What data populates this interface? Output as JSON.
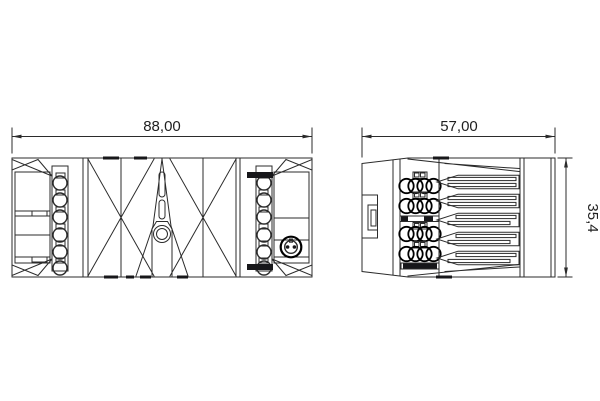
{
  "drawing": {
    "type": "technical-drawing",
    "dimensions": {
      "front_width": "88,00",
      "side_width": "57,00",
      "side_height": "35,4"
    },
    "colors": {
      "line": "#2b2b2b",
      "bold_line": "#000000",
      "background": "#ffffff"
    }
  }
}
